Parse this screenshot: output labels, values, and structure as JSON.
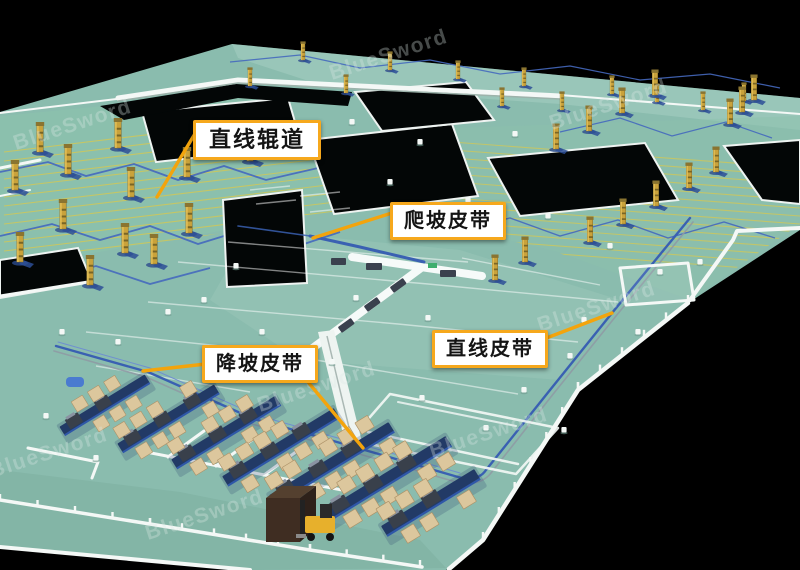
{
  "labels": [
    {
      "id": "straight-roller-conveyor",
      "text": "直线辊道"
    },
    {
      "id": "incline-belt",
      "text": "爬坡皮带"
    },
    {
      "id": "decline-belt",
      "text": "降坡皮带"
    },
    {
      "id": "straight-belt",
      "text": "直线皮带"
    }
  ],
  "watermark": {
    "text": "BlueSword"
  },
  "colors": {
    "background": "#000000",
    "floor": "#8abcae",
    "floor_top": "#9dcabd",
    "floor_bottom": "#7cab9c",
    "zone_green": "#8cc2ad",
    "wall_white": "#f4f8f6",
    "belt_blue": "#3a60b2",
    "belt_light": "#6f8fd0",
    "path_yellow": "#d9c94e",
    "tower_yellow": "#c9a23b",
    "tower_stripe": "#6b5a22",
    "box_tan": "#dcc79d",
    "platform_navy": "#223a66",
    "machine_gray": "#39404b",
    "callout_border": "#f6a81c",
    "callout_bg": "#ffffff",
    "callout_text": "#141414",
    "leader": "#f3a40c",
    "void_black": "#030606"
  }
}
